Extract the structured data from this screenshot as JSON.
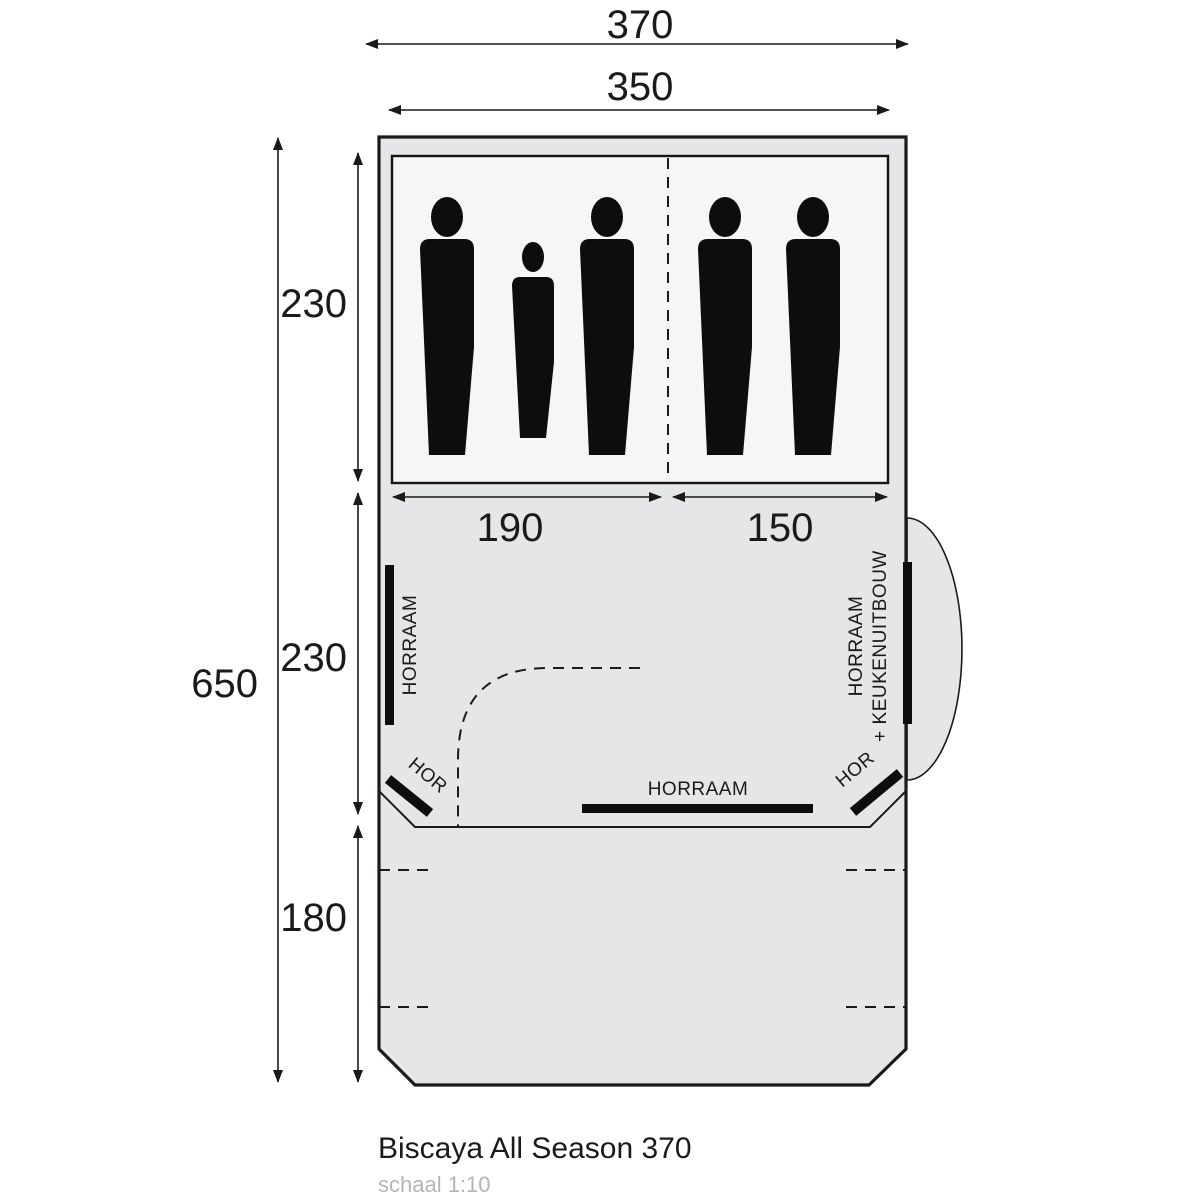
{
  "title": "Biscaya All Season 370",
  "scale_note": "schaal 1:10",
  "dimensions": {
    "outer_width": "370",
    "inner_width": "350",
    "total_length": "650",
    "sleeping_length": "230",
    "living_length": "230",
    "canopy_length": "180",
    "cabin_left_width": "190",
    "cabin_right_width": "150"
  },
  "labels": {
    "window_left": "HORRAAM",
    "window_right_line1": "HORRAAM",
    "window_right_line2": "+ KEUKENUITBOUW",
    "window_bottom": "HORRAAM",
    "door_window_left": "HOR",
    "door_window_right": "HOR"
  },
  "colors": {
    "tent_fill": "#e4e6e7",
    "sleeping_fill": "#f6f6f6",
    "line": "#1a1a1a",
    "muted_text": "#b5b5b5"
  },
  "occupants": {
    "adults": 4,
    "children": 1
  }
}
